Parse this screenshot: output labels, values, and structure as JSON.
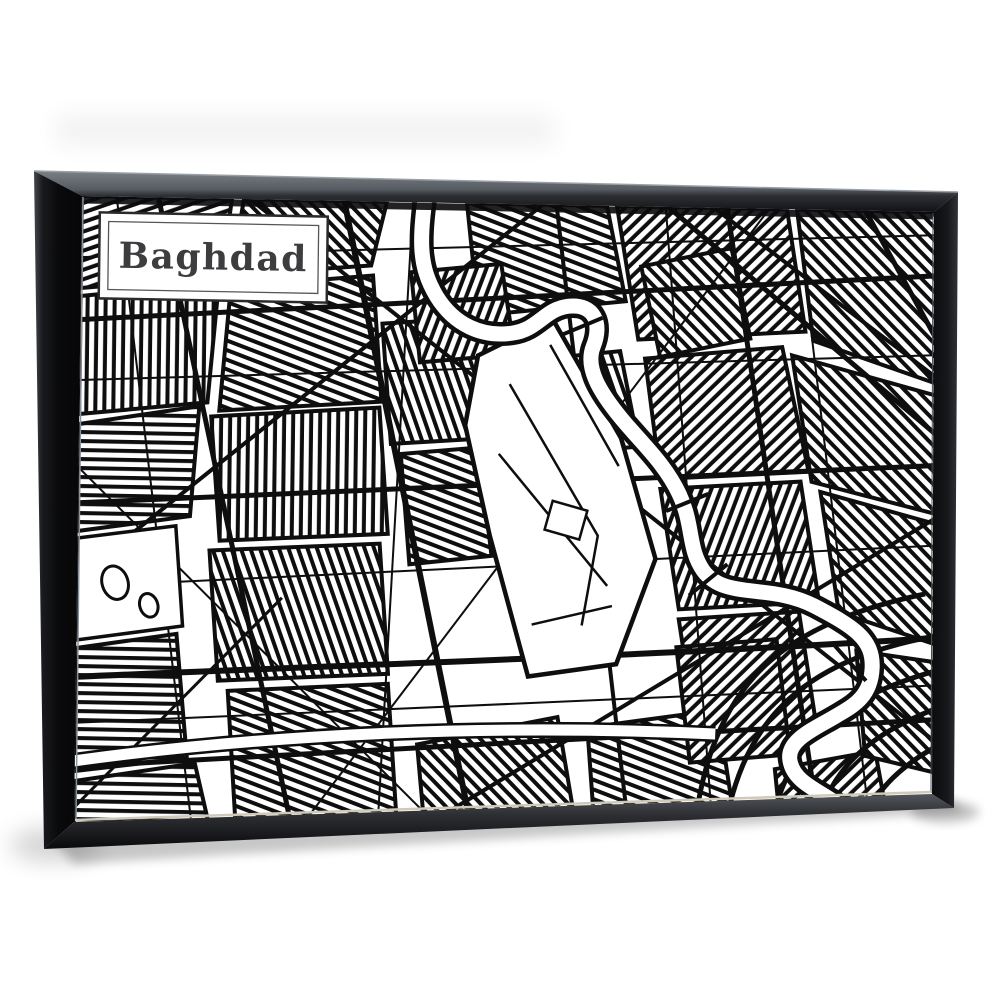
{
  "scene": {
    "background_color": "#ffffff",
    "description": "Product photo of a framed wall-art print hanging on a white background"
  },
  "artwork": {
    "title": "Baghdad",
    "style": "black and white city street map line art",
    "canvas_color": "#ffffff",
    "ink_color": "#0e0e0e",
    "frame": {
      "type": "black floating frame",
      "face_color": "#121316",
      "top_bevel_color": "#6b7077"
    },
    "label": {
      "text": "Baghdad",
      "text_color": "#3d3d3f",
      "border_color": "#2a2a2c"
    }
  }
}
